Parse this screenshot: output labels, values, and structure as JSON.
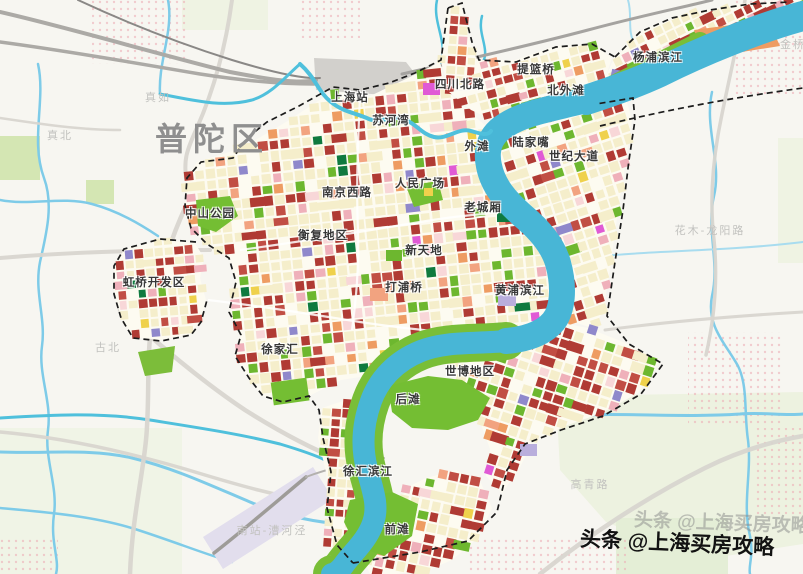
{
  "title_label": {
    "text": "普陀区"
  },
  "watermark": {
    "ghost_text": "头条 @上海买房攻略",
    "bold_text": "头条 @上海买房攻略"
  },
  "labels": [
    {
      "t": "上海站",
      "x": 350,
      "y": 97
    },
    {
      "t": "苏河湾",
      "x": 391,
      "y": 120
    },
    {
      "t": "四川北路",
      "x": 460,
      "y": 84
    },
    {
      "t": "提篮桥",
      "x": 536,
      "y": 69
    },
    {
      "t": "北外滩",
      "x": 566,
      "y": 90
    },
    {
      "t": "杨浦滨江",
      "x": 658,
      "y": 57
    },
    {
      "t": "外滩",
      "x": 477,
      "y": 146
    },
    {
      "t": "陆家嘴",
      "x": 531,
      "y": 142
    },
    {
      "t": "世纪大道",
      "x": 574,
      "y": 156
    },
    {
      "t": "南京西路",
      "x": 347,
      "y": 192
    },
    {
      "t": "人民广场",
      "x": 420,
      "y": 183
    },
    {
      "t": "老城厢",
      "x": 483,
      "y": 207
    },
    {
      "t": "中山公园",
      "x": 210,
      "y": 213
    },
    {
      "t": "衡复地区",
      "x": 323,
      "y": 235
    },
    {
      "t": "新天地",
      "x": 424,
      "y": 250
    },
    {
      "t": "虹桥开发区",
      "x": 154,
      "y": 282
    },
    {
      "t": "打浦桥",
      "x": 404,
      "y": 287
    },
    {
      "t": "黄浦滨江",
      "x": 520,
      "y": 290
    },
    {
      "t": "徐家汇",
      "x": 280,
      "y": 349
    },
    {
      "t": "世博地区",
      "x": 470,
      "y": 371
    },
    {
      "t": "后滩",
      "x": 408,
      "y": 399
    },
    {
      "t": "徐汇滨江",
      "x": 368,
      "y": 471
    },
    {
      "t": "前滩",
      "x": 397,
      "y": 529
    }
  ],
  "faint_labels": [
    {
      "t": "真如",
      "x": 158,
      "y": 97
    },
    {
      "t": "真北",
      "x": 60,
      "y": 135
    },
    {
      "t": "古北",
      "x": 108,
      "y": 347
    },
    {
      "t": "金桥",
      "x": 793,
      "y": 44
    },
    {
      "t": "花木-龙阳路",
      "x": 710,
      "y": 230
    },
    {
      "t": "高青路",
      "x": 590,
      "y": 484
    },
    {
      "t": "南站-漕河泾",
      "x": 272,
      "y": 530
    }
  ],
  "palette": {
    "bg": "#F7F6F1",
    "streetBase": "#FDFBF1",
    "water": "#48B6D6",
    "waterCreek": "#4FC0DC",
    "blueLine": "#7ECBE8",
    "blueLineLight": "#A8DCEF",
    "riverGreen": "#79BE37",
    "parkBig": "#74BE33",
    "palePark": "#EDF2E0",
    "palePark2": "#CBE2A4",
    "tileCream": "#F5EECB",
    "tileRed": "#B03B34",
    "tileRed2": "#C14E44",
    "tileGreen": "#6DB72F",
    "tileDarkGreen": "#0F7A3F",
    "tileOrange": "#EE9C62",
    "tilePink": "#EFB0BA",
    "tileLightPink": "#F8D7D8",
    "tileSalmon": "#F2A380",
    "tileMagenta": "#E05AD5",
    "tilePurple": "#8F88CB",
    "tileYellow": "#EFD14C",
    "lavender": "#B9AEDC",
    "road": "#D8D5CF",
    "rail": "#ACAAA6",
    "railDark": "#8A8886",
    "stationFill": "#D2D0CC",
    "yardFill": "#E2DEED",
    "boundary": "#1C1C1C",
    "dotPink": "#EDAEB6",
    "labelDark": "#383838",
    "labelFaint": "#C2C2BF",
    "bigLabel": "#8F8F8F"
  }
}
